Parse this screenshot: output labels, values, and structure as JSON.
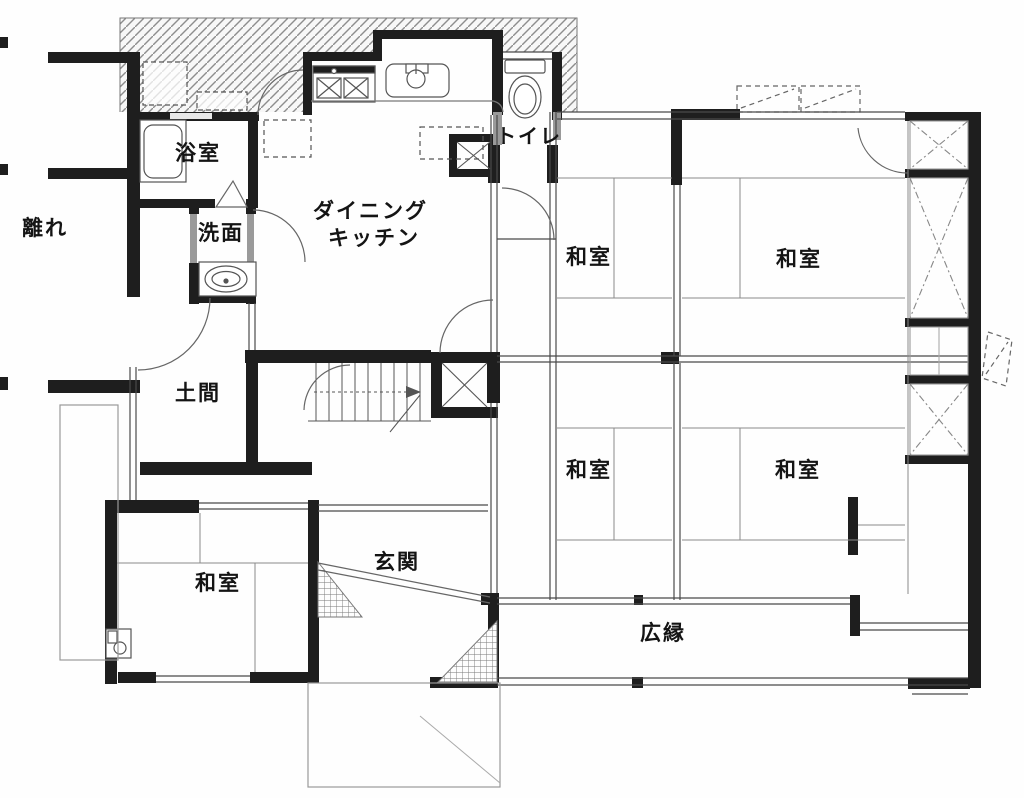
{
  "plan": {
    "type": "floorplan",
    "labels": {
      "hanare": "離れ",
      "bathroom": "浴室",
      "washroom": "洗面",
      "dk_line1": "ダイニング",
      "dk_line2": "キッチン",
      "toilet": "トイレ",
      "doma": "土間",
      "genkan": "玄関",
      "hiroen": "広縁"
    },
    "rooms": [
      {
        "id": "washitsu-upper-left",
        "label": "和室"
      },
      {
        "id": "washitsu-upper-right",
        "label": "和室"
      },
      {
        "id": "washitsu-lower-left",
        "label": "和室"
      },
      {
        "id": "washitsu-lower-right",
        "label": "和室"
      },
      {
        "id": "washitsu-bottom-left",
        "label": "和室"
      }
    ],
    "colors": {
      "wall": "#1e1e1e",
      "thin_line": "#666666",
      "opening_gray": "#9a9a9a",
      "background": "#fefefe"
    }
  }
}
